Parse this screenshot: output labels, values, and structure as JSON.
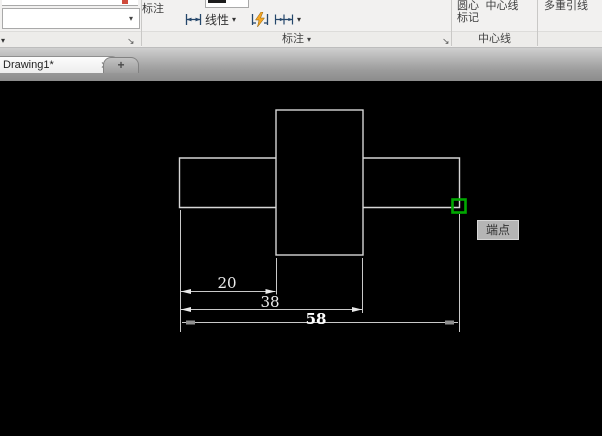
{
  "ribbon": {
    "dim_tool_label": "标注",
    "linear_label": "线性",
    "dim_panel_title": "标注",
    "center_mark_label_line1": "圆心",
    "center_mark_label_line2": "标记",
    "centerline_label": "中心线",
    "centerline_panel_title": "中心线",
    "multileader_label": "多重引线"
  },
  "icons": {
    "dropdown_glyph": "▾",
    "launcher_glyph": "↘",
    "close_glyph": "×",
    "new_tab_glyph": "+"
  },
  "tabs": {
    "drawing_tab_label": "Drawing1*"
  },
  "canvas": {
    "dim_20": "20",
    "dim_38": "38",
    "dim_58": "58",
    "snap_tooltip": "端点",
    "colors": {
      "background": "#000000",
      "geometry_line": "#d6d6d6",
      "dimension_line": "#c9c9c9",
      "dimension_text": "#f2f2f2",
      "snap_marker_green": "#00a800",
      "tooltip_bg": "#b5b5b5",
      "tooltip_text": "#333333"
    }
  }
}
